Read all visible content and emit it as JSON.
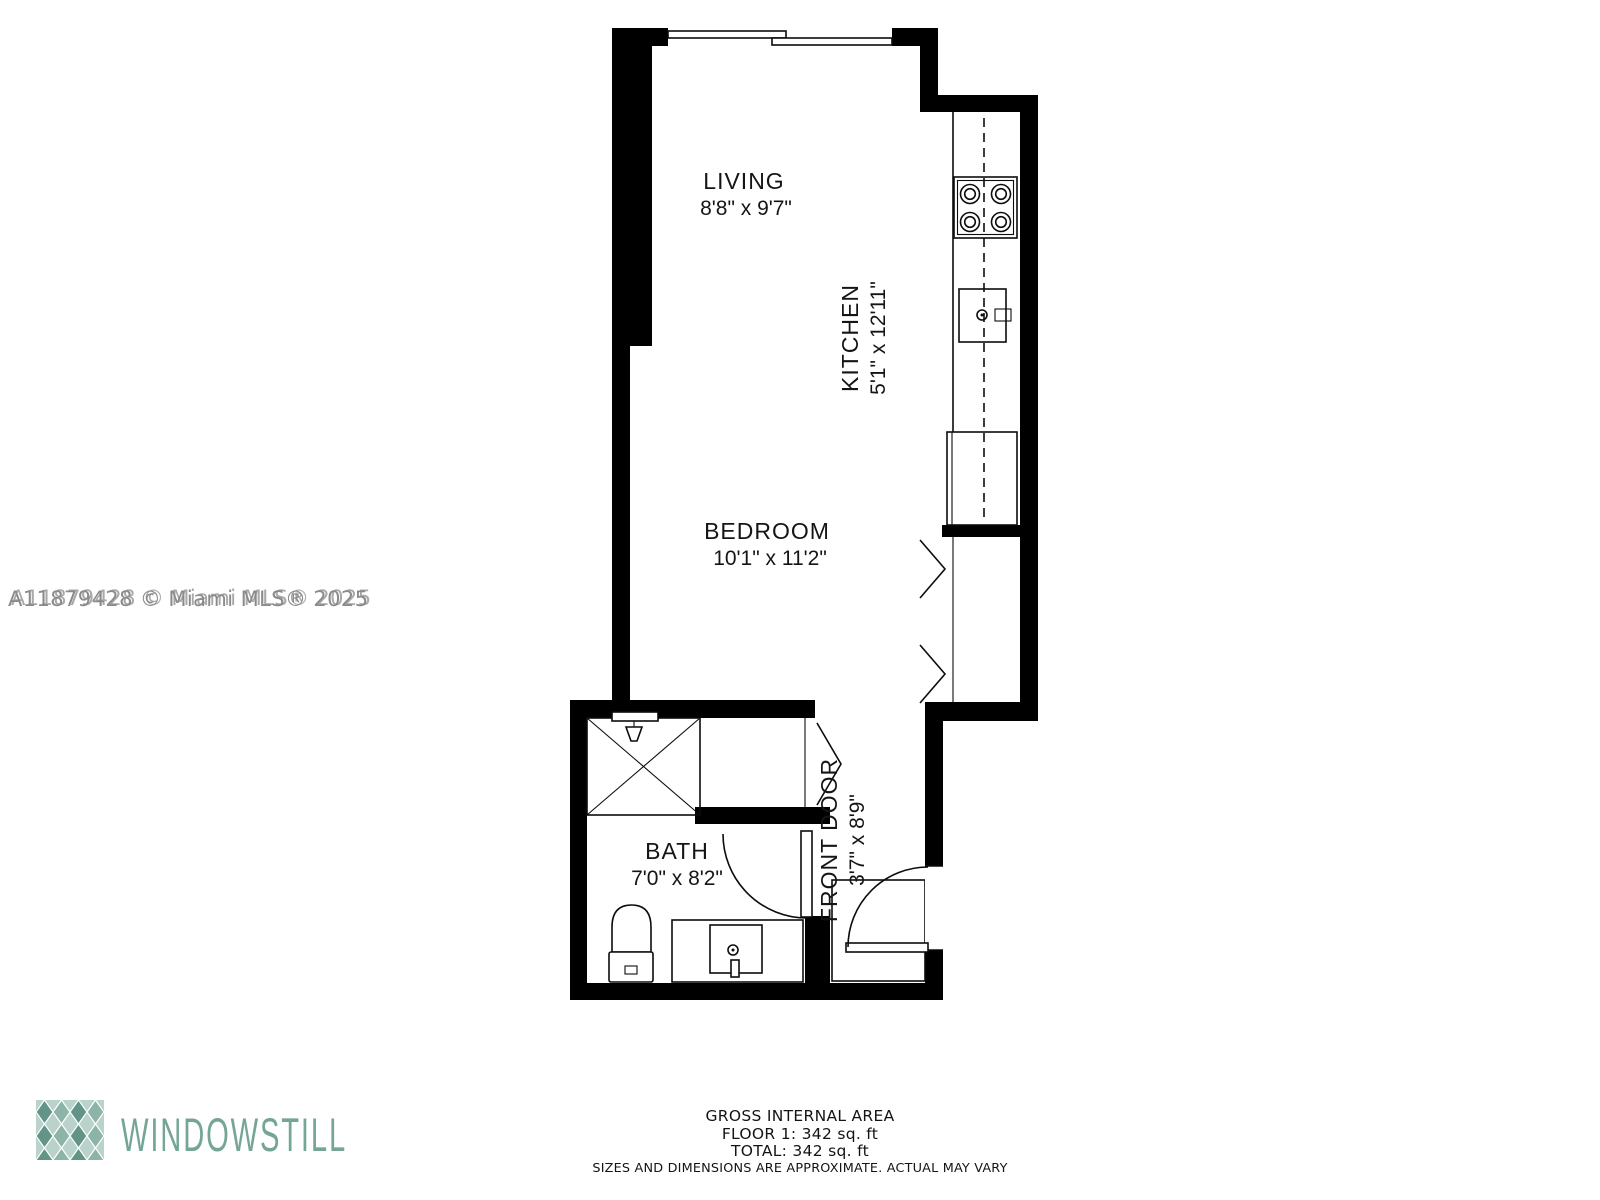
{
  "plan": {
    "rooms": {
      "living": {
        "name": "LIVING",
        "dims": "8'8\" x 9'7\""
      },
      "kitchen": {
        "name": "KITCHEN",
        "dims": "5'1\" x 12'11\""
      },
      "bedroom": {
        "name": "BEDROOM",
        "dims": "10'1\" x 11'2\""
      },
      "bath": {
        "name": "BATH",
        "dims": "7'0\" x 8'2\""
      },
      "front_door": {
        "name": "FRONT DOOR",
        "dims": "3'7\" x 8'9\""
      }
    }
  },
  "watermark": {
    "text": "A11879428 © Miami MLS® 2025",
    "color": "#8a8a8a",
    "ghost_color": "#a9a9a9"
  },
  "footer": {
    "area_title": "GROSS INTERNAL AREA",
    "floor_line": "FLOOR 1: 342 sq. ft",
    "total_line": "TOTAL: 342 sq. ft",
    "disclaimer": "SIZES AND DIMENSIONS ARE APPROXIMATE. ACTUAL MAY VARY"
  },
  "logo": {
    "text": "WINDOWSTILL",
    "teal": "#74a597"
  },
  "colors": {
    "wall": "#000000",
    "logo_teal": "#74a597",
    "watermark_gray": "#8a8a8a"
  }
}
